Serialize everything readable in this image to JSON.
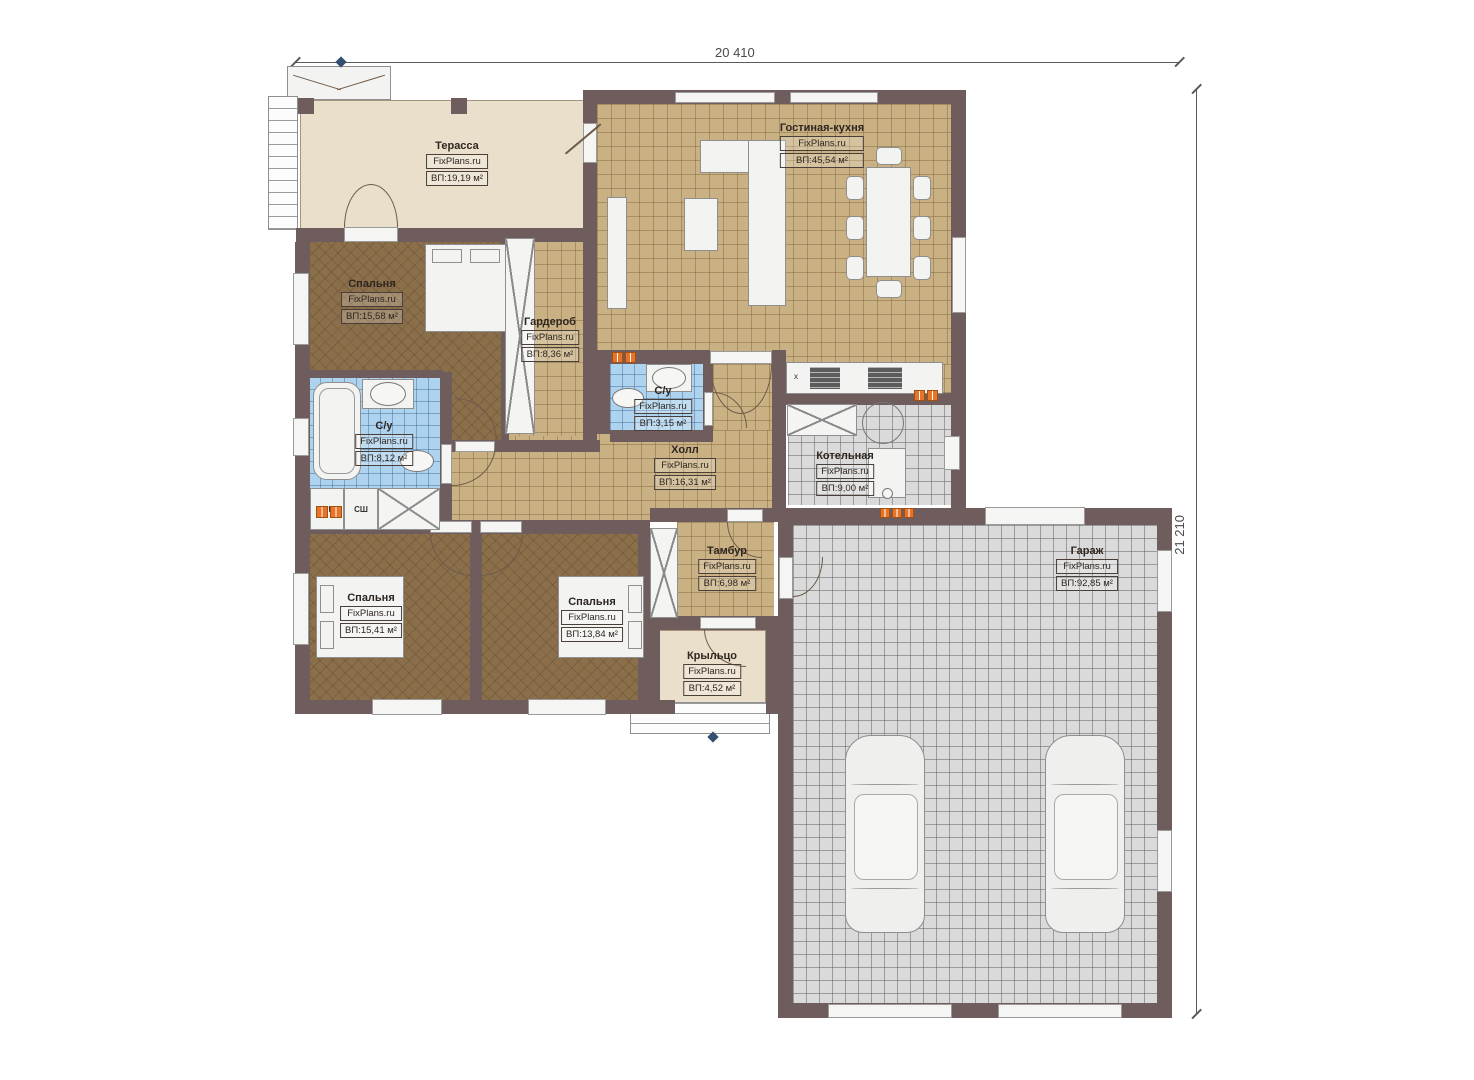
{
  "brand": {
    "text": "FixPlans.ru"
  },
  "dimensions": {
    "width_label": "20 410",
    "height_label": "21 210"
  },
  "rooms": {
    "terrace": {
      "name": "Терасса",
      "area": "ВП:19,19 м²"
    },
    "living_kitchen": {
      "name": "Гостиная-кухня",
      "area": "ВП:45,54 м²"
    },
    "bedroom_master": {
      "name": "Спальня",
      "area": "ВП:15,58 м²"
    },
    "wardrobe": {
      "name": "Гардероб",
      "area": "ВП:8,36 м²"
    },
    "bathroom_small": {
      "name": "С/у",
      "area": "ВП:3,15 м²"
    },
    "bathroom_main": {
      "name": "С/у",
      "area": "ВП:8,12 м²"
    },
    "hall": {
      "name": "Холл",
      "area": "ВП:16,31 м²"
    },
    "boiler": {
      "name": "Котельная",
      "area": "ВП:9,00 м²"
    },
    "tambur": {
      "name": "Тамбур",
      "area": "ВП:6,98 м²"
    },
    "porch": {
      "name": "Крыльцо",
      "area": "ВП:4,52 м²"
    },
    "garage": {
      "name": "Гараж",
      "area": "ВП:92,85 м²"
    },
    "bedroom_2": {
      "name": "Спальня",
      "area": "ВП:15,41 м²"
    },
    "bedroom_3": {
      "name": "Спальня",
      "area": "ВП:13,84 м²"
    }
  },
  "markers": {
    "washing_machine": "СтМ",
    "drying_cabinet": "СШ",
    "stove_mark": "х"
  },
  "colors": {
    "wall": "#6f5c5c",
    "tan_floor": "#c9b184",
    "bedroom_floor": "#8b6f4a",
    "blue_tile": "#aed3ee",
    "gray_floor": "#dadada",
    "terrace_fill": "#e9dfcb",
    "vent": "#e8742a"
  }
}
